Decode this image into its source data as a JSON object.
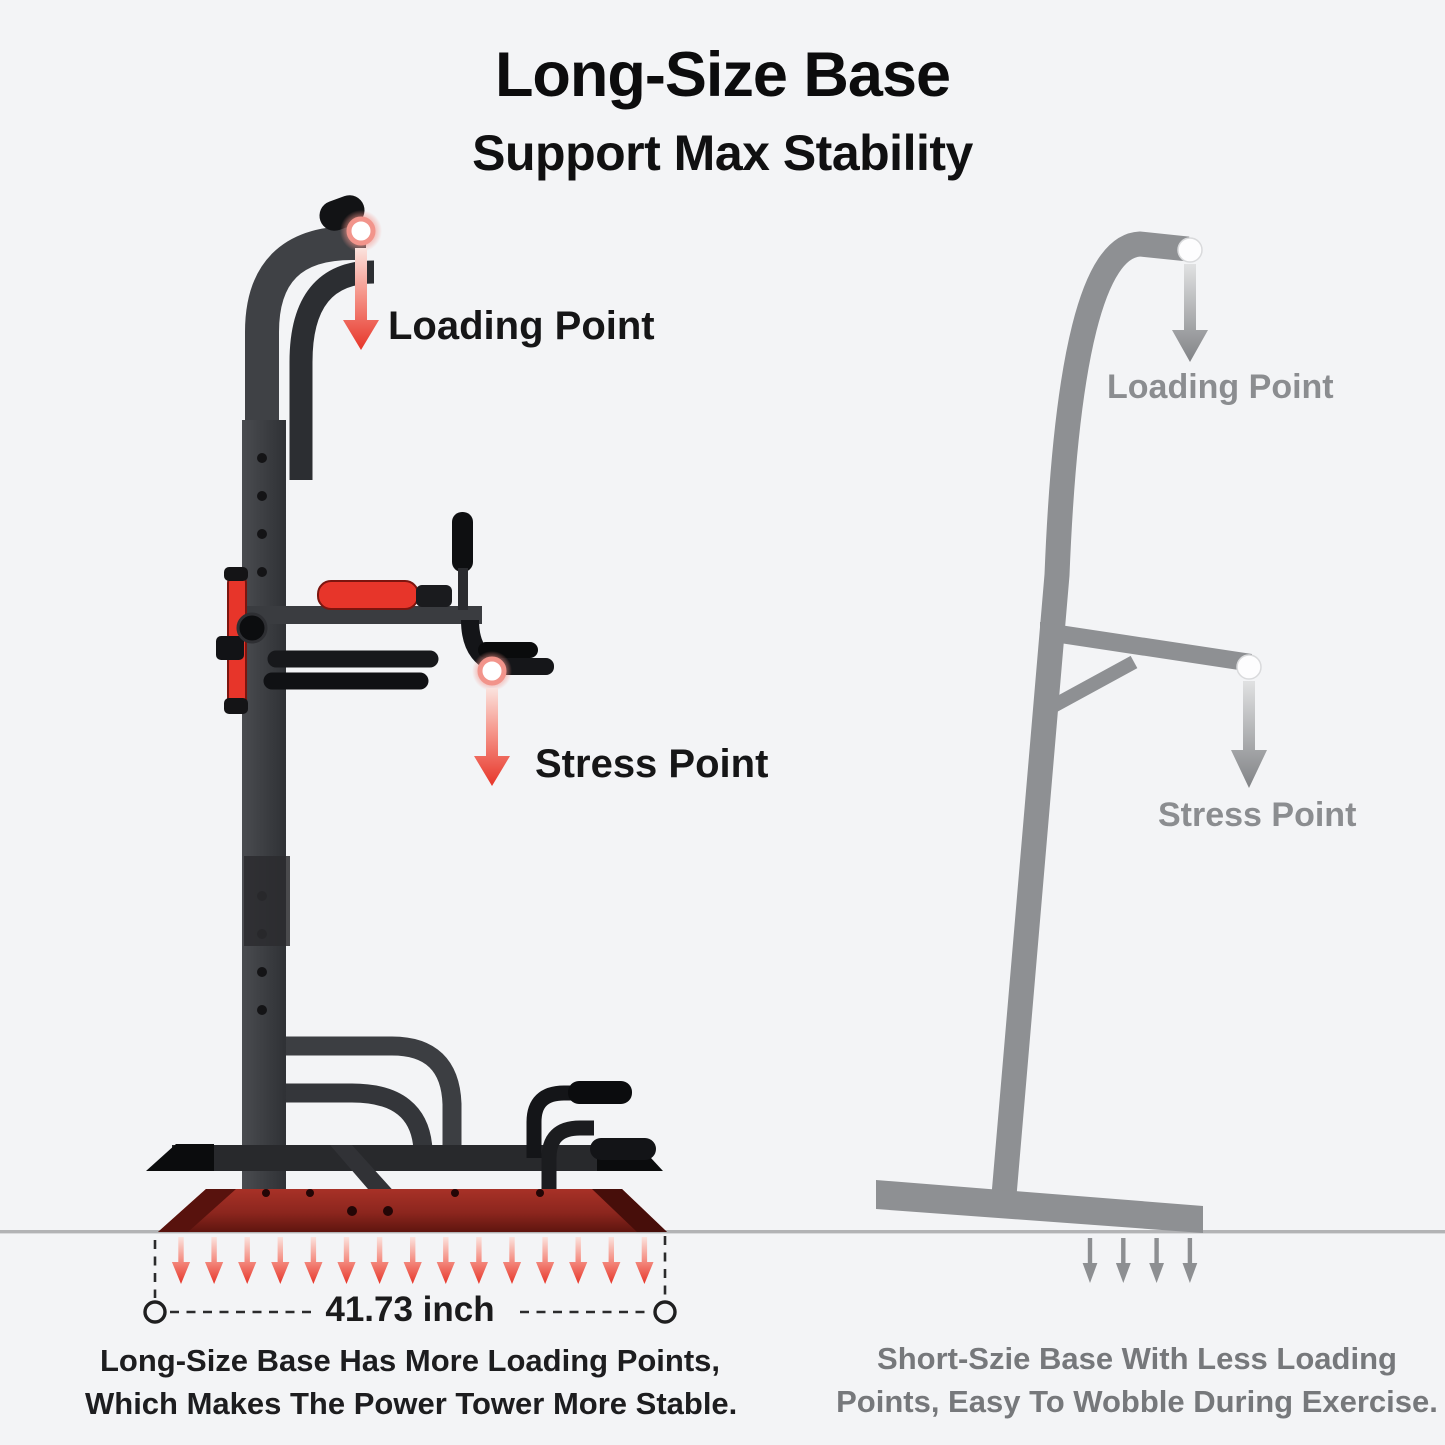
{
  "page": {
    "title": "Long-Size Base",
    "subtitle": "Support Max Stability"
  },
  "left_panel": {
    "name": "long-size base power tower",
    "loading_point_label": "Loading Point",
    "stress_point_label": "Stress Point",
    "base_width_label": "41.73 inch",
    "caption_line1": "Long-Size Base Has More Loading Points,",
    "caption_line2": "Which Makes The Power Tower More Stable.",
    "floor_arrow_count": 15
  },
  "right_panel": {
    "name": "short-size base stand silhouette",
    "loading_point_label": "Loading Point",
    "stress_point_label": "Stress Point",
    "caption_line1": "Short-Szie Base With Less Loading",
    "caption_line2": "Points, Easy To Wobble During Exercise.",
    "floor_arrow_count": 4
  },
  "colors": {
    "background": "#f3f4f6",
    "accent_red": "#e73529",
    "base_red": "#8c261e",
    "frame_dark": "#3a3c40",
    "silhouette_gray": "#8e9093",
    "text_dark": "#111111",
    "text_gray": "#8b8d90",
    "ground_line": "#b2b3b5"
  }
}
